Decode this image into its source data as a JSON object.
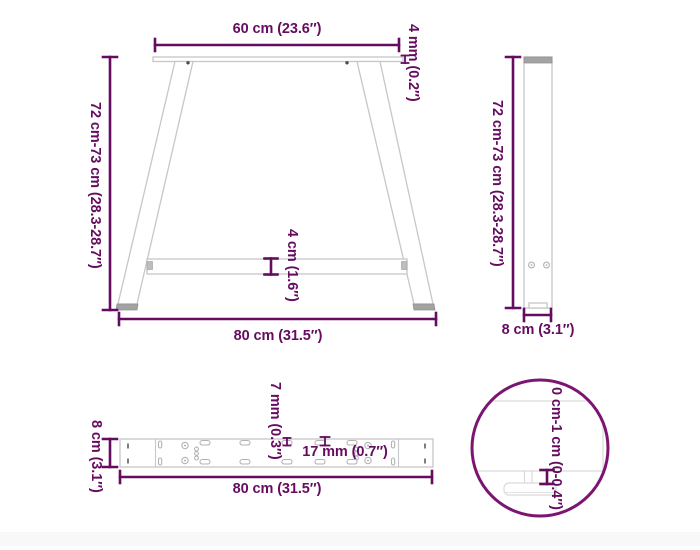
{
  "colors": {
    "dimension": "#650c60",
    "detail_circle": "#7c1472",
    "line_art": "#c5c7c9",
    "line_art_light": "#d9d9d9",
    "dark_fill": "#a3a3a3",
    "background": "#ffffff"
  },
  "front_view": {
    "top_width_label": "60 cm (23.6″)",
    "plate_thickness_label": "4 mm (0.2″)",
    "height_label": "72 cm-73 cm (28.3-28.7″)",
    "crossbar_label": "4 cm (1.6″)",
    "bottom_width_label": "80 cm (31.5″)"
  },
  "side_view": {
    "height_label": "72 cm-73 cm (28.3-28.7″)",
    "depth_label": "8 cm (3.1″)"
  },
  "top_view": {
    "depth_label": "8 cm (3.1″)",
    "small_hole_label": "7 mm (0.3″)",
    "slot_label": "17 mm (0.7″)",
    "length_label": "80 cm (31.5″)"
  },
  "detail_view": {
    "foot_adjustment_label": "0 cm-1 cm (0-0.4″)"
  }
}
